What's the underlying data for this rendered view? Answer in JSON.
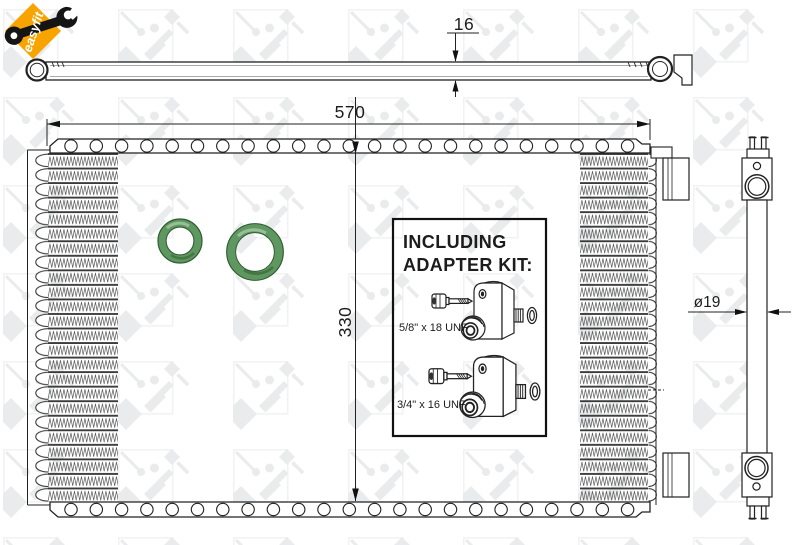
{
  "brand_badge": {
    "label": "easyfit",
    "badge_color": "#f7a400",
    "wrench_icon": "wrench-icon"
  },
  "dimensions": {
    "top_thickness": "16",
    "core_width": "570",
    "core_height": "330",
    "pipe_diameter": "ø19"
  },
  "adapter_kit": {
    "title_line1": "INCLUDING",
    "title_line2": "ADAPTER KIT:",
    "items": [
      {
        "label": "5/8\" x 18 UNF"
      },
      {
        "label": "3/4\" x 16 UNF"
      }
    ]
  },
  "colors": {
    "line": "#222222",
    "oring_green": "#5e975f",
    "oring_edge_green": "#2f5c31",
    "watermark_gray": "#e9ebec",
    "badge_orange": "#f7a400"
  }
}
